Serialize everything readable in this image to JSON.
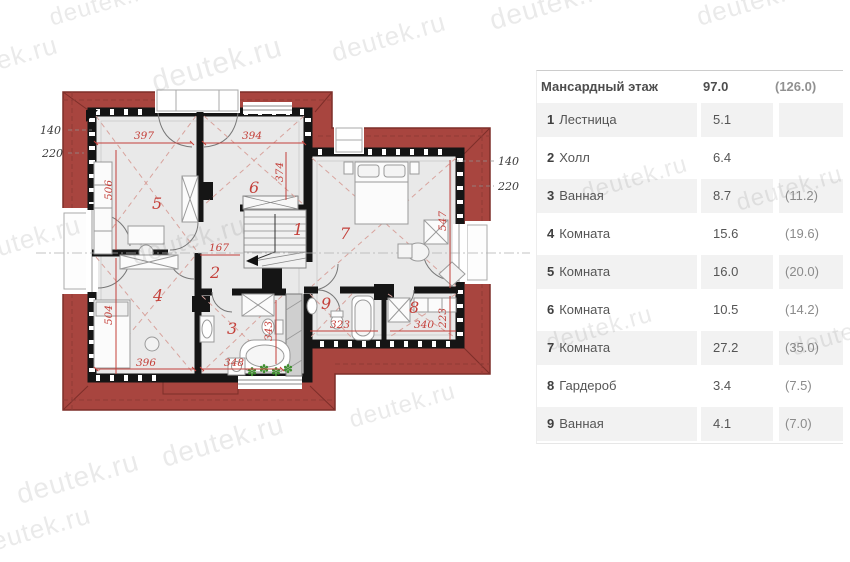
{
  "watermark": {
    "text": "deutek.ru"
  },
  "legend": {
    "title": "Мансардный этаж",
    "area_net": "97.0",
    "area_gross": "(126.0)",
    "rows": [
      {
        "num": "1",
        "name": "Лестница",
        "net": "5.1",
        "gross": ""
      },
      {
        "num": "2",
        "name": "Холл",
        "net": "6.4",
        "gross": ""
      },
      {
        "num": "3",
        "name": "Ванная",
        "net": "8.7",
        "gross": "(11.2)"
      },
      {
        "num": "4",
        "name": "Комната",
        "net": "15.6",
        "gross": "(19.6)"
      },
      {
        "num": "5",
        "name": "Комната",
        "net": "16.0",
        "gross": "(20.0)"
      },
      {
        "num": "6",
        "name": "Комната",
        "net": "10.5",
        "gross": "(14.2)"
      },
      {
        "num": "7",
        "name": "Комната",
        "net": "27.2",
        "gross": "(35.0)"
      },
      {
        "num": "8",
        "name": "Гардероб",
        "net": "3.4",
        "gross": "(7.5)"
      },
      {
        "num": "9",
        "name": "Ванная",
        "net": "4.1",
        "gross": "(7.0)"
      }
    ]
  },
  "plan": {
    "rooms": {
      "n1": "1",
      "n2": "2",
      "n3": "3",
      "n4": "4",
      "n5": "5",
      "n6": "6",
      "n7": "7",
      "n8": "8",
      "n9": "9"
    },
    "dims": {
      "d397": "397",
      "d394": "394",
      "d506": "506",
      "d374": "374",
      "d167": "167",
      "d504": "504",
      "d396": "396",
      "d348": "348",
      "d343": "343",
      "d323": "323",
      "d340": "340",
      "d223": "223",
      "d547": "547"
    },
    "ext": {
      "left_140": "140",
      "left_220": "220",
      "right_140": "140",
      "right_220": "220"
    },
    "icons": {
      "plant": "✽"
    },
    "colors": {
      "roof": "#a8453f",
      "roof_line": "#7d2e29",
      "wall": "#151515",
      "floor": "#e9e9e9",
      "dim_red": "#c4403a",
      "plant_green": "#3f8f2f"
    }
  }
}
